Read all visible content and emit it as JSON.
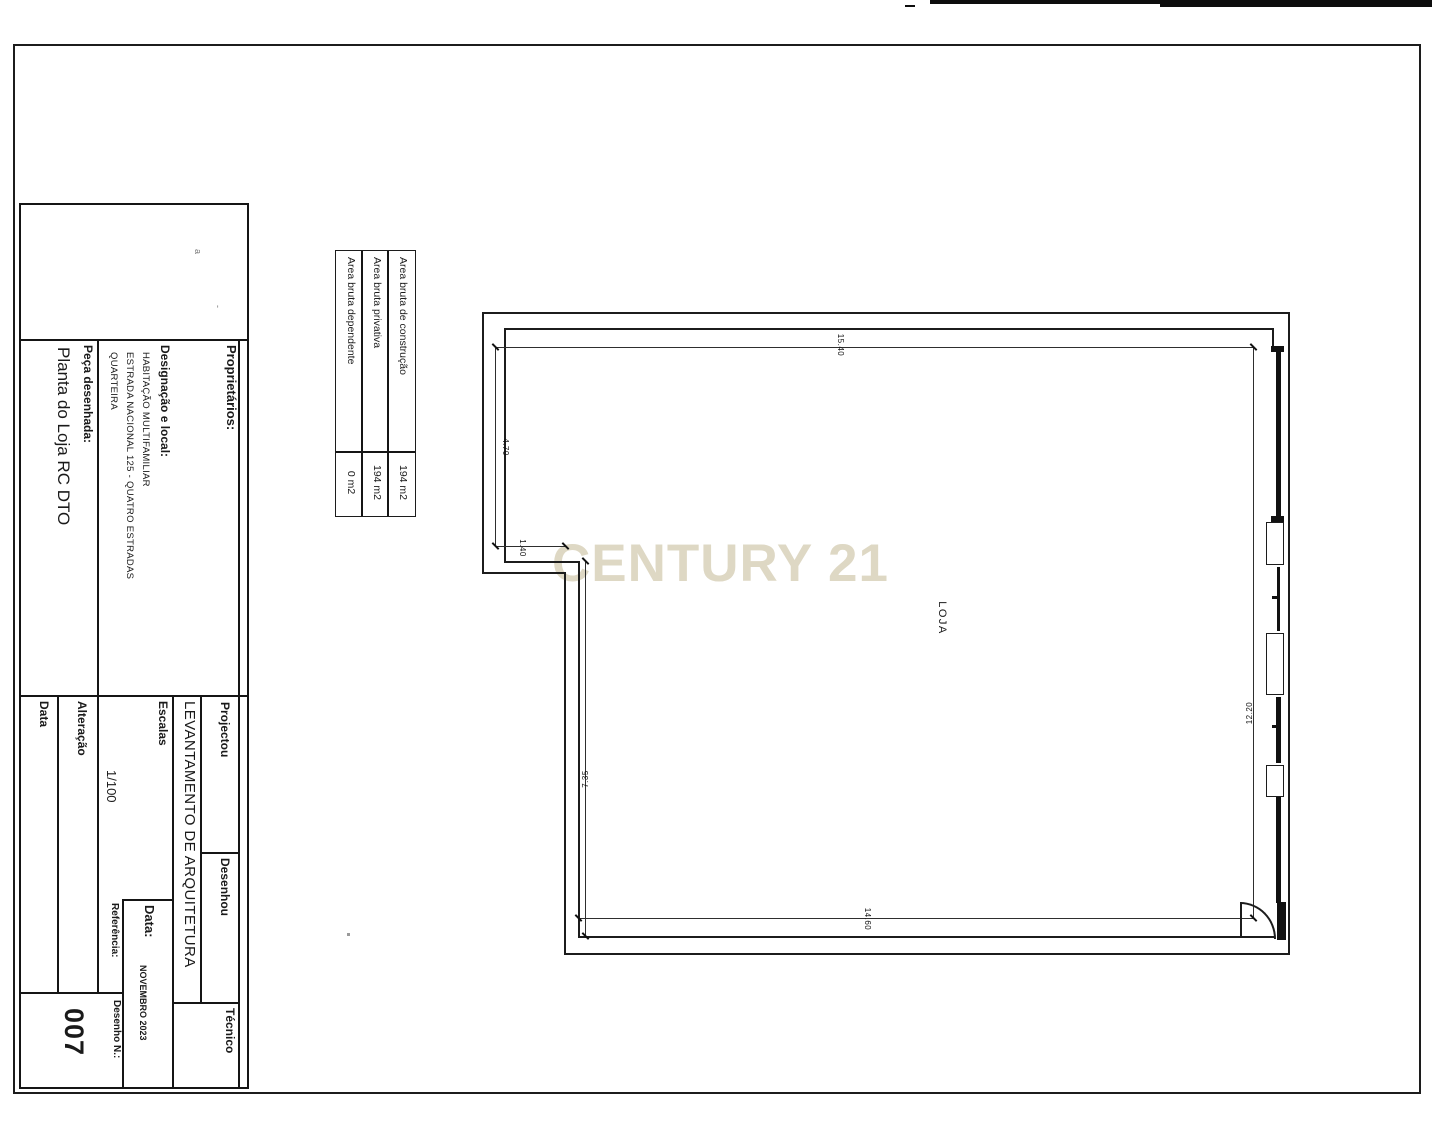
{
  "colors": {
    "line": "#1c1c1c",
    "watermark": "#ded8c4"
  },
  "watermark": "CENTURY 21",
  "area_table": {
    "rows": [
      {
        "label": "Area bruta de construção",
        "value": "194 m2"
      },
      {
        "label": "Area bruta privativa",
        "value": "194 m2"
      },
      {
        "label": "Area bruta dependente",
        "value": "0 m2"
      }
    ]
  },
  "title_block": {
    "proprietarios_label": "Proprietários:",
    "projectou_label": "Projectou",
    "desenhou_label": "Desenhou",
    "tecnico_label": "Técnico",
    "designacao_label": "Designação e local:",
    "designacao_line1": "HABITAÇÃO MULTIFAMILIAR",
    "designacao_line2": "ESTRADA NACIONAL 125 - QUATRO ESTRADAS",
    "designacao_line3": "QUARTEIRA",
    "peca_label": "Peça desenhada:",
    "peca_value": "Planta do Loja RC DTO",
    "levantamento": "LEVANTAMENTO DE ARQUITETURA",
    "escalas_label": "Escalas",
    "escalas_value": "1/100",
    "alteracao_label": "Alteração",
    "data_col_label": "Data",
    "data_label": "Data:",
    "data_value": "NOVEMBRO 2023",
    "referencia_label": "Referência:",
    "desenho_label": "Desenho N.:",
    "desenho_value": "007"
  },
  "plan": {
    "room_label": "LOJA",
    "dim_top": "15.40",
    "dim_left_upper": "4.70",
    "dim_notch": "1.40",
    "dim_left_lower": "7.35",
    "dim_bottom": "14.60",
    "dim_right": "12.20"
  }
}
